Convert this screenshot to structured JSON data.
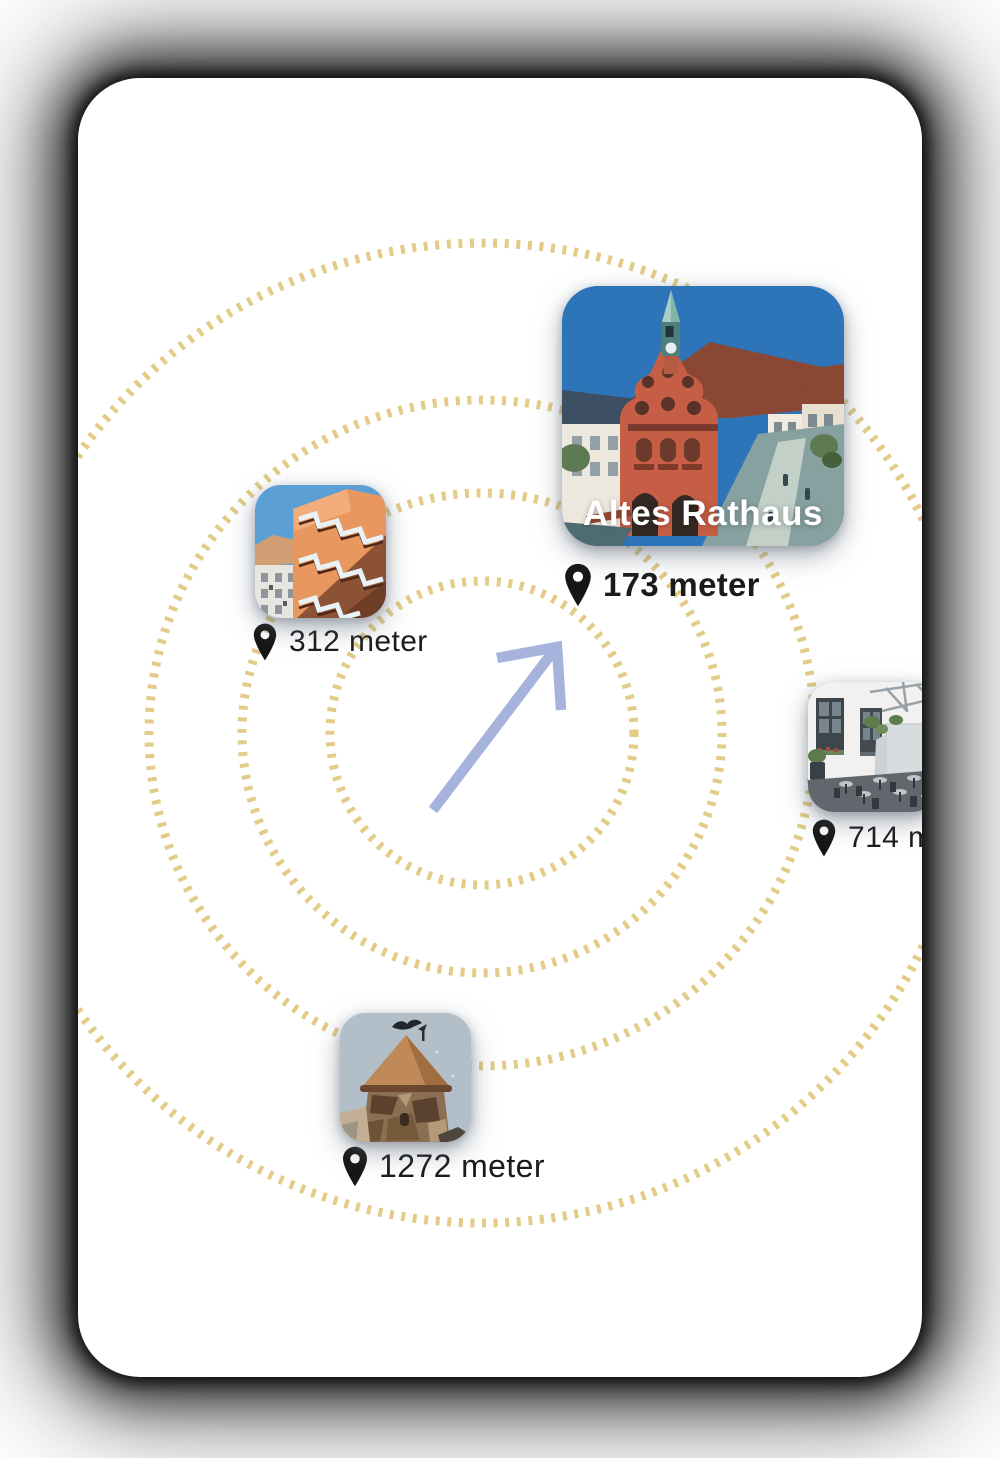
{
  "radar": {
    "ring_color": "#DFC87E",
    "rings": [
      "152",
      "240",
      "333",
      "490"
    ],
    "arrow_color": "#A6B3DC",
    "arrow_direction": "north-east"
  },
  "icons": {
    "pin_color": "#161616",
    "pin_name": "location-pin-icon"
  },
  "pois": [
    {
      "title": "Altes Rathaus",
      "distance": "173 meter",
      "image": "old-town-hall-illustration"
    },
    {
      "distance": "312 meter",
      "image": "orange-stair-building-photo"
    },
    {
      "distance": "714 m",
      "image": "courtyard-cafe-photo"
    },
    {
      "distance": "1272 meter",
      "image": "stone-tower-photo"
    }
  ]
}
